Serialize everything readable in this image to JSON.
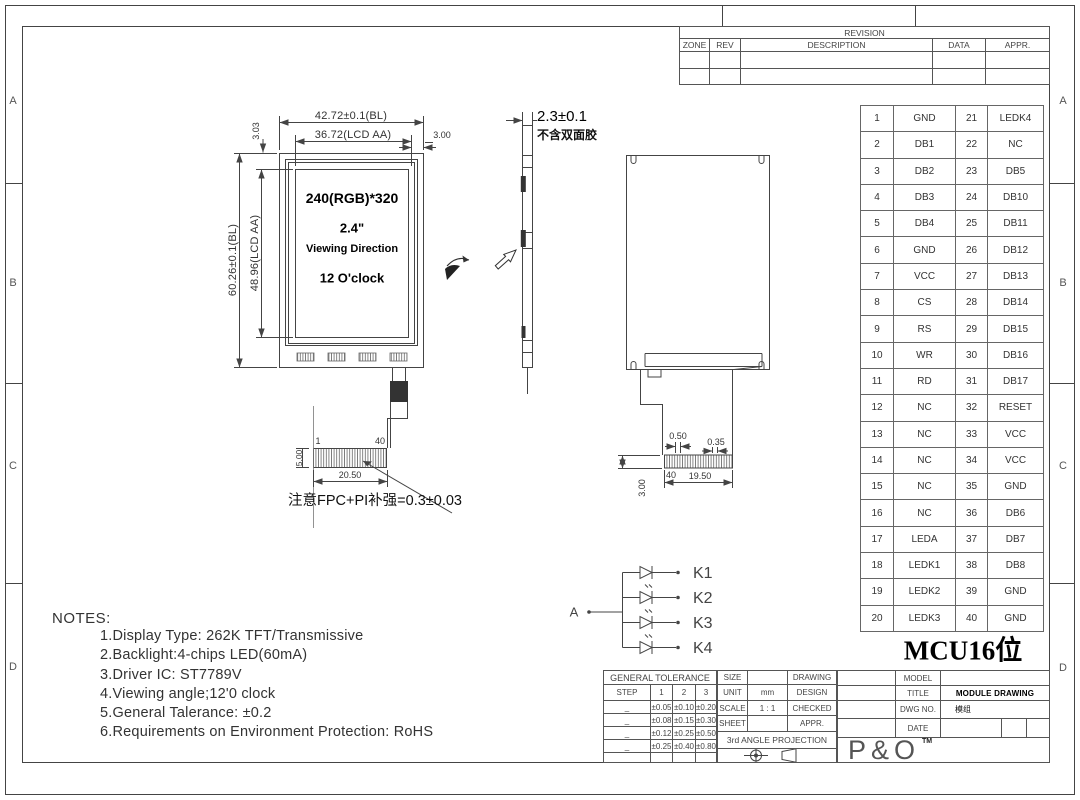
{
  "frame": {
    "zones_left": [
      "A",
      "B",
      "C",
      "D"
    ],
    "zones_right": [
      "A",
      "B",
      "C",
      "D"
    ]
  },
  "revision": {
    "title": "REVISION",
    "headers": [
      "ZONE",
      "REV",
      "DESCRIPTION",
      "DATA",
      "APPR."
    ],
    "rows": [
      [
        "",
        "",
        "",
        "",
        ""
      ],
      [
        "",
        "",
        "",
        "",
        ""
      ]
    ]
  },
  "front_view": {
    "dim_width_outer": "42.72±0.1(BL)",
    "dim_width_aa": "36.72(LCD AA)",
    "dim_side_margin": "3.00",
    "dim_top_margin": "3.03",
    "dim_height_outer": "60.26±0.1(BL)",
    "dim_height_aa": "48.96(LCD AA)",
    "resolution": "240(RGB)*320",
    "size_inch": "2.4\"",
    "viewing_label": "Viewing Direction",
    "viewing_value": "12 O'clock",
    "pin_first": "1",
    "pin_last": "40",
    "dim_fpc_width": "20.50",
    "dim_fpc_height": "5.00",
    "fpc_note": "注意FPC+PI补强=0.3±0.03"
  },
  "side_view": {
    "dim_thickness": "2.3±0.1",
    "tape_note": "不含双面胶"
  },
  "back_view": {
    "dim_pad_pitch": "0.50",
    "dim_pad_width": "0.35",
    "pin_label": "40",
    "dim_contact_width": "19.50",
    "dim_tail": "3.00"
  },
  "led_circuit": {
    "anode_label": "A",
    "cathode_labels": [
      "K1",
      "K2",
      "K3",
      "K4"
    ]
  },
  "pin_table": {
    "rows": [
      [
        "1",
        "GND",
        "21",
        "LEDK4"
      ],
      [
        "2",
        "DB1",
        "22",
        "NC"
      ],
      [
        "3",
        "DB2",
        "23",
        "DB5"
      ],
      [
        "4",
        "DB3",
        "24",
        "DB10"
      ],
      [
        "5",
        "DB4",
        "25",
        "DB11"
      ],
      [
        "6",
        "GND",
        "26",
        "DB12"
      ],
      [
        "7",
        "VCC",
        "27",
        "DB13"
      ],
      [
        "8",
        "CS",
        "28",
        "DB14"
      ],
      [
        "9",
        "RS",
        "29",
        "DB15"
      ],
      [
        "10",
        "WR",
        "30",
        "DB16"
      ],
      [
        "11",
        "RD",
        "31",
        "DB17"
      ],
      [
        "12",
        "NC",
        "32",
        "RESET"
      ],
      [
        "13",
        "NC",
        "33",
        "VCC"
      ],
      [
        "14",
        "NC",
        "34",
        "VCC"
      ],
      [
        "15",
        "NC",
        "35",
        "GND"
      ],
      [
        "16",
        "NC",
        "36",
        "DB6"
      ],
      [
        "17",
        "LEDA",
        "37",
        "DB7"
      ],
      [
        "18",
        "LEDK1",
        "38",
        "DB8"
      ],
      [
        "19",
        "LEDK2",
        "39",
        "GND"
      ],
      [
        "20",
        "LEDK3",
        "40",
        "GND"
      ]
    ],
    "caption": "MCU16位"
  },
  "notes": {
    "heading": "NOTES:",
    "items": [
      "1.Display Type: 262K TFT/Transmissive",
      "2.Backlight:4-chips LED(60mA)",
      "3.Driver IC: ST7789V",
      "4.Viewing angle;12'0 clock",
      "5.General Talerance: ±0.2",
      "6.Requirements on Environment Protection: RoHS"
    ]
  },
  "title_block": {
    "tolerance": {
      "title": "GENERAL TOLERANCE",
      "step_label": "STEP",
      "cols": [
        "1",
        "2",
        "3"
      ],
      "rows": [
        [
          "_",
          "±0.05",
          "±0.10",
          "±0.20"
        ],
        [
          "_",
          "±0.08",
          "±0.15",
          "±0.30"
        ],
        [
          "_",
          "±0.12",
          "±0.25",
          "±0.50"
        ],
        [
          "_",
          "±0.25",
          "±0.40",
          "±0.80"
        ]
      ]
    },
    "info": {
      "size_label": "SIZE",
      "size_value": "",
      "unit_label": "UNIT",
      "unit_value": "mm",
      "scale_label": "SCALE",
      "scale_value": "1 : 1",
      "sheet_label": "SHEET",
      "sheet_value": "",
      "drawing_label": "DRAWING",
      "design_label": "DESIGN",
      "checked_label": "CHECKED",
      "appr_label": "APPR.",
      "projection": "3rd ANGLE PROJECTION"
    },
    "doc": {
      "model_label": "MODEL",
      "model_value": "",
      "title_label": "TITLE",
      "title_value": "MODULE DRAWING",
      "dwg_label": "DWG NO.",
      "dwg_value": "模组",
      "date_label": "DATE",
      "date_value": "",
      "logo": "P&O",
      "logo_tm": "TM"
    }
  }
}
